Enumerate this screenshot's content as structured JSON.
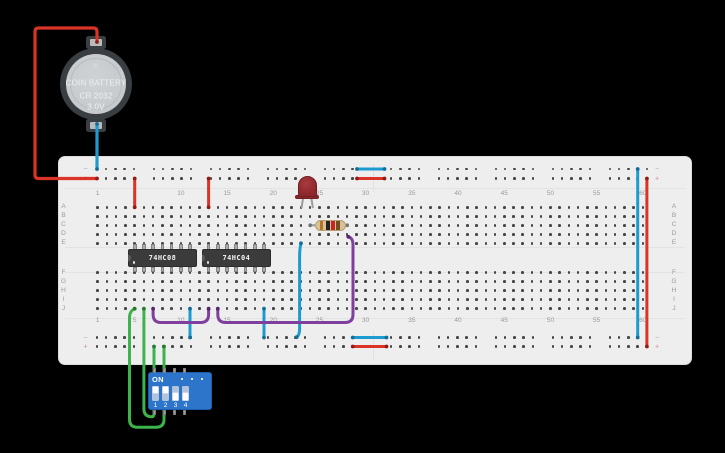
{
  "background": "#000000",
  "battery": {
    "line1": "COIN BATTERY",
    "line2": "CR 2032",
    "line3": "3.0V",
    "plus_label": "+"
  },
  "board": {
    "top_row_letters": [
      "A",
      "B",
      "C",
      "D",
      "E"
    ],
    "bottom_row_letters": [
      "F",
      "G",
      "H",
      "I",
      "J"
    ],
    "column_count": 60,
    "column_label_first": 1,
    "column_label_step": 5,
    "rail_minus_label": "−",
    "rail_plus_label": "+",
    "rail_minus_color": "#8fa9c0",
    "rail_plus_color": "#d08a8a"
  },
  "ics": [
    {
      "label": "74HC08",
      "pin1_col": 5
    },
    {
      "label": "74HC04",
      "pin1_col": 13
    }
  ],
  "led": {
    "color": "red"
  },
  "resistor": {
    "bands": [
      "brown",
      "black",
      "red",
      "gold"
    ],
    "band_hex": [
      "#b5722e",
      "#222222",
      "#cc2222",
      "#6e4f1f"
    ]
  },
  "dip_switch": {
    "on_label": "ON",
    "numbers": [
      "1",
      "2",
      "3",
      "4"
    ],
    "states": [
      "on",
      "on",
      "off",
      "off"
    ]
  },
  "colors": {
    "wire_red": "#db3325",
    "wire_blue": "#1d9bd1",
    "wire_green": "#3cb44b",
    "wire_purple": "#7e3f9d",
    "wire_gray": "#9c9c9c"
  },
  "wires": [
    {
      "name": "battery-positive-wire",
      "color": "#db3325",
      "cap": "#8f1d16",
      "w": 3.2,
      "path": "M97,42 L97,31.5 Q97,28 93.5,28 L38.5,28 Q35,28 35,31.5 L35,175 Q35,178.5 38.5,178.5 L97,178.5",
      "caps": [
        [
          97,
          42
        ],
        [
          97,
          178.5
        ]
      ]
    },
    {
      "name": "battery-negative-wire",
      "color": "#1d9bd1",
      "cap": "#136e97",
      "w": 3.2,
      "path": "M97,124 L97,169",
      "caps": [
        [
          97,
          124
        ],
        [
          97,
          169
        ]
      ]
    },
    {
      "name": "vcc-jumper-ic1",
      "color": "#db3325",
      "cap": "#8f1d16",
      "w": 3,
      "path": "M134.7,178.5 L134.7,207.3",
      "caps": [
        [
          134.7,
          178.5
        ],
        [
          134.7,
          207.3
        ]
      ]
    },
    {
      "name": "vcc-jumper-ic2",
      "color": "#db3325",
      "cap": "#8f1d16",
      "w": 3,
      "path": "M208.6,178.5 L208.6,207.3",
      "caps": [
        [
          208.6,
          178.5
        ],
        [
          208.6,
          207.3
        ]
      ]
    },
    {
      "name": "top-rail-bridge-negative",
      "color": "#1d9bd1",
      "cap": "#136e97",
      "w": 3,
      "path": "M357,169 L384.5,169",
      "caps": [
        [
          357,
          169
        ],
        [
          384.5,
          169
        ]
      ]
    },
    {
      "name": "top-rail-bridge-positive",
      "color": "#db3325",
      "cap": "#8f1d16",
      "w": 3,
      "path": "M357,178.5 L384.5,178.5",
      "caps": [
        [
          357,
          178.5
        ],
        [
          384.5,
          178.5
        ]
      ]
    },
    {
      "name": "bottom-rail-bridge-negative",
      "color": "#1d9bd1",
      "cap": "#136e97",
      "w": 3,
      "path": "M352.7,337.5 L386.5,337.5",
      "caps": [
        [
          352.7,
          337.5
        ],
        [
          386.5,
          337.5
        ]
      ]
    },
    {
      "name": "bottom-rail-bridge-positive",
      "color": "#db3325",
      "cap": "#8f1d16",
      "w": 3,
      "path": "M352.7,346.5 L386.5,346.5",
      "caps": [
        [
          352.7,
          346.5
        ],
        [
          386.5,
          346.5
        ]
      ]
    },
    {
      "name": "right-rail-jumper-negative",
      "color": "#1d9bd1",
      "cap": "#136e97",
      "w": 3,
      "path": "M637.7,169 L637.7,337.5",
      "caps": [
        [
          637.7,
          169
        ],
        [
          637.7,
          337.5
        ]
      ]
    },
    {
      "name": "right-rail-jumper-positive",
      "color": "#db3325",
      "cap": "#8f1d16",
      "w": 3,
      "path": "M646.9,178.5 L646.9,346.5",
      "caps": [
        [
          646.9,
          178.5
        ],
        [
          646.9,
          346.5
        ]
      ]
    },
    {
      "name": "ic1-ground-jumper",
      "color": "#1d9bd1",
      "cap": "#136e97",
      "w": 3,
      "path": "M190,308.7 L190,337.5",
      "caps": [
        [
          190,
          308.7
        ],
        [
          190,
          337.5
        ]
      ]
    },
    {
      "name": "ic2-ground-jumper",
      "color": "#1d9bd1",
      "cap": "#136e97",
      "w": 3,
      "path": "M264,308.7 L264,337.5",
      "caps": [
        [
          264,
          308.7
        ],
        [
          264,
          337.5
        ]
      ]
    },
    {
      "name": "led-cathode-to-ground",
      "color": "#1d9bd1",
      "cap": "#136e97",
      "w": 3,
      "path": "M301,243.3 C299.8,248 299.6,251 299.6,257 L299.6,329 C299.6,333.5 298.3,336 296.6,337.2",
      "caps": [
        [
          301,
          243.3
        ],
        [
          296.6,
          337.2
        ]
      ]
    },
    {
      "name": "and-output-to-inverter-input",
      "color": "#7e3f9d",
      "cap": "#55276e",
      "w": 3,
      "path": "M153.1,308.7 L153.1,314.5 Q153.1,322.5 161.1,322.5 L200.6,322.5 Q208.6,322.5 208.6,314.5 L208.6,308.7",
      "caps": [
        [
          153.1,
          308.7
        ],
        [
          208.6,
          308.7
        ]
      ]
    },
    {
      "name": "inverter-output-to-resistor",
      "color": "#7e3f9d",
      "cap": "#55276e",
      "w": 3,
      "path": "M217.8,308.7 L217.8,314.5 Q217.8,322.5 225.8,322.5 L345,322.5 Q353,322.5 353,314.5 L353,245 Q353,237.8 348.3,236.8",
      "caps": [
        [
          217.8,
          308.7
        ],
        [
          348.3,
          236.8
        ]
      ]
    },
    {
      "name": "switch1-to-ic1-input",
      "color": "#3cb44b",
      "cap": "#277a34",
      "w": 3,
      "path": "M143.9,308.7 L143.9,408.8 Q143.9,416.8 151.9,416.8 Q154,416.8 154,412.8 L154,410.8",
      "caps": [
        [
          143.9,
          308.7
        ],
        [
          154,
          410.8
        ]
      ]
    },
    {
      "name": "switch2-to-ic1-input",
      "color": "#3cb44b",
      "cap": "#277a34",
      "w": 3,
      "path": "M134.7,308.7 C131.2,310.4 129.5,313 129.5,317.5 L129.5,419.3 Q129.5,427.3 137.5,427.3 L156,427.3 Q164,427.3 164,419.3 L164,410.8",
      "caps": [
        [
          134.7,
          308.7
        ],
        [
          164,
          410.8
        ]
      ]
    },
    {
      "name": "switch1-power-wire",
      "color": "#3cb44b",
      "cap": "#277a34",
      "w": 3,
      "path": "M154,346.5 L154,371.8",
      "caps": [
        [
          154,
          346.5
        ],
        [
          154,
          371.8
        ]
      ]
    },
    {
      "name": "switch2-power-wire",
      "color": "#3cb44b",
      "cap": "#277a34",
      "w": 3,
      "path": "M164,346.5 L164,371.8",
      "caps": [
        [
          164,
          346.5
        ],
        [
          164,
          371.8
        ]
      ]
    },
    {
      "name": "resistor-lead",
      "color": "#9c9c9c",
      "cap": "#757575",
      "w": 2.2,
      "path": "M310.2,225.3 L347.2,225.3",
      "caps": [
        [
          310.2,
          225.3
        ],
        [
          347.2,
          225.3
        ]
      ]
    },
    {
      "name": "led-leg-cathode",
      "color": "#9c9c9c",
      "cap": "#9c9c9c",
      "w": 2,
      "path": "M303.2,197.5 L301.6,207.3",
      "caps": []
    },
    {
      "name": "led-leg-anode",
      "color": "#9c9c9c",
      "cap": "#9c9c9c",
      "w": 2,
      "path": "M311.2,197.5 L312.8,207.3",
      "caps": []
    }
  ]
}
